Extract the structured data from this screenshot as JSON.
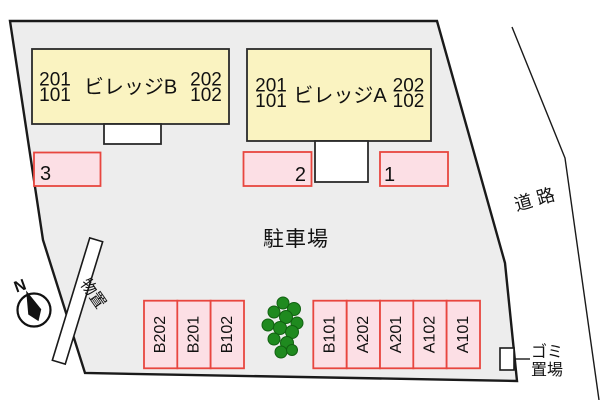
{
  "buildings": [
    {
      "name": "ビレッジB",
      "left_top": "201",
      "left_bottom": "101",
      "right_top": "202",
      "right_bottom": "102"
    },
    {
      "name": "ビレッジA",
      "left_top": "201",
      "left_bottom": "101",
      "right_top": "202",
      "right_bottom": "102"
    }
  ],
  "parking": {
    "area_label": "駐車場",
    "numbered": [
      "3",
      "2",
      "1"
    ],
    "stalls": [
      "B202",
      "B201",
      "B102",
      "B101",
      "A202",
      "A201",
      "A102",
      "A101"
    ]
  },
  "labels": {
    "road": "道路",
    "storage_shed": "物置",
    "garbage_line1": "ゴミ",
    "garbage_line2": "置場",
    "compass_north": "N"
  },
  "colors": {
    "background": "#ffffff",
    "site_fill": "#ededed",
    "outline": "#1a1a1a",
    "building_fill": "#faf3c1",
    "parking_space_fill": "#fcdfe5",
    "parking_space_border": "#e8463f",
    "tree_green": "#1f8a1f"
  }
}
